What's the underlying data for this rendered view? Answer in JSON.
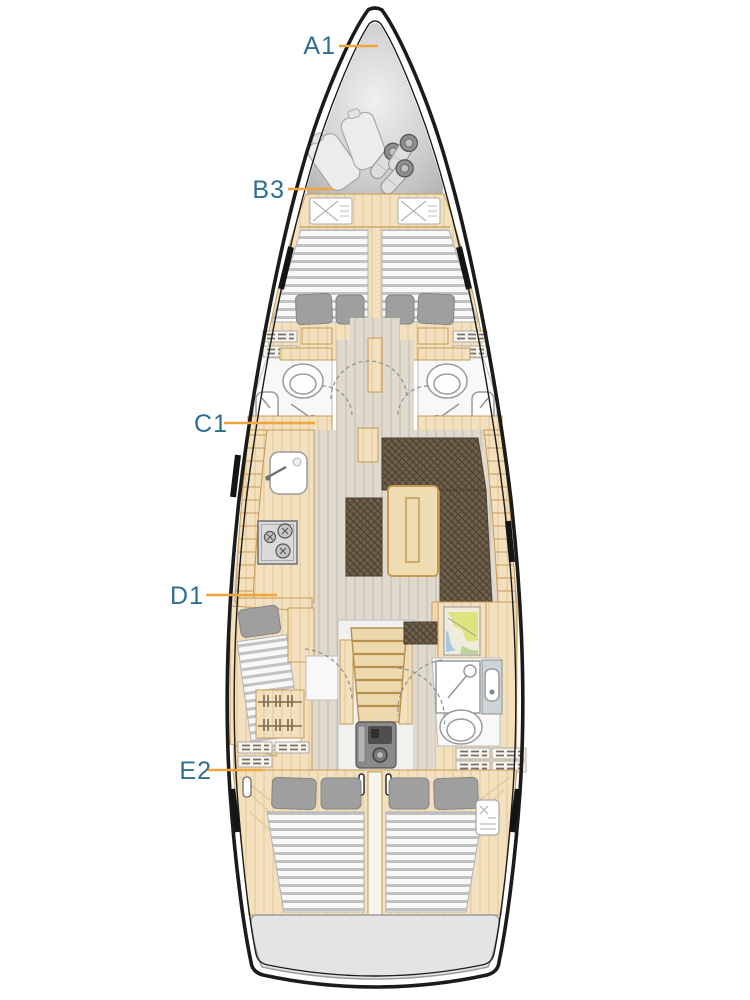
{
  "labels": {
    "a1": "A1",
    "b3": "B3",
    "c1": "C1",
    "d1": "D1",
    "e2": "E2"
  },
  "colors": {
    "label_text": "#2e6e8e",
    "leader_line": "#f0a43c",
    "hull_outline": "#1b1b1b",
    "wood_furniture": "#f3e0bf",
    "wood_border": "#c79a56",
    "floor": "#dfdacd",
    "floor_stripe": "#d2ccbf",
    "sofa_dark": "#6e604c",
    "mattress": "#f8f8f8",
    "mattress_stripe": "#c2c2c2",
    "pillow": "#9f9f9f",
    "bow_locker_gray": "#bdbdbd",
    "transom_gray": "#e4e4e4",
    "fixture_white": "#f8f8f8",
    "engine_gray": "#8a8a8a"
  }
}
